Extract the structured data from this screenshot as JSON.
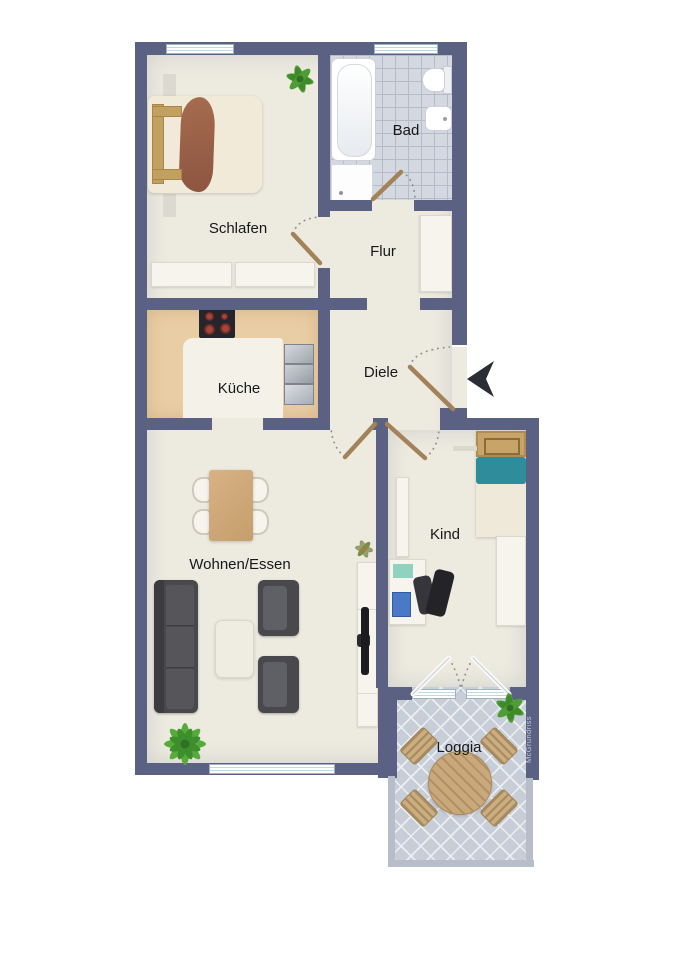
{
  "rooms": {
    "schlafen": {
      "label": "Schlafen"
    },
    "bad": {
      "label": "Bad"
    },
    "flur": {
      "label": "Flur"
    },
    "kueche": {
      "label": "Küche"
    },
    "diele": {
      "label": "Diele"
    },
    "wohnen_essen": {
      "label": "Wohnen/Essen"
    },
    "kind": {
      "label": "Kind"
    },
    "loggia": {
      "label": "Loggia"
    }
  },
  "watermark": {
    "label": "McGrundriss"
  },
  "entrance": {
    "indicator": "arrow-pointing-left-into-diele"
  },
  "colors": {
    "wall": "#5b6183",
    "floor": "#edebdf",
    "kitchen_floor": "#e9cda4",
    "bath_tile": "#d4d8e1",
    "loggia_tile": "#c8ced8",
    "wood": "#c2a05f",
    "blanket_brown": "#9a6047",
    "teal_accent": "#2e8c9b",
    "dark_furniture": "#49494d",
    "door_leaf": "#a3825a",
    "entrance_arrow": "#2a2d36",
    "plant_green": "#4f9d35"
  },
  "furniture": {
    "schlafen": [
      "double-bed",
      "nightstand",
      "nightstand",
      "dresser",
      "dresser",
      "plant"
    ],
    "bad": [
      "bathtub",
      "shower",
      "toilet",
      "sink"
    ],
    "flur": [
      "wardrobe"
    ],
    "kueche": [
      "stove",
      "kitchen-sink-unit"
    ],
    "wohnen_essen": [
      "dining-table",
      "dining-chair",
      "dining-chair",
      "dining-chair",
      "dining-chair",
      "sofa",
      "armchair",
      "armchair",
      "coffee-table",
      "sideboard",
      "tv",
      "plant",
      "plant"
    ],
    "kind": [
      "child-bed",
      "wardrobe",
      "cabinet",
      "desk",
      "office-chair",
      "wall-shelf"
    ],
    "loggia": [
      "round-table",
      "patio-chair",
      "patio-chair",
      "patio-chair",
      "patio-chair",
      "plant"
    ]
  }
}
